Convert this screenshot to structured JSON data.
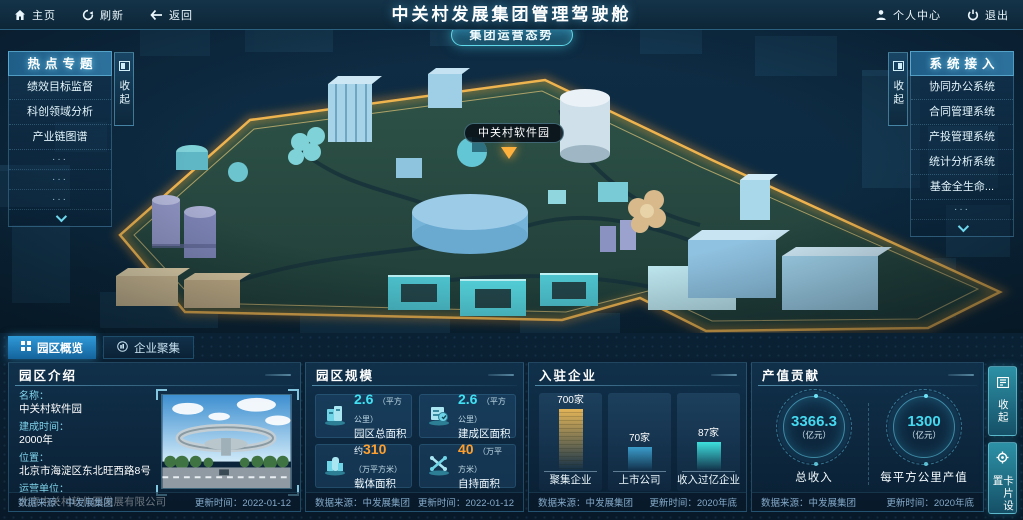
{
  "topbar": {
    "home_label": "主页",
    "refresh_label": "刷新",
    "back_label": "返回",
    "title": "中关村发展集团管理驾驶舱",
    "personal_center_label": "个人中心",
    "logout_label": "退出"
  },
  "map": {
    "situation_button_label": "集团运营态势",
    "park_marker_label": "中关村软件园"
  },
  "hot_topics": {
    "title": "热点专题",
    "collapse_label": "收起",
    "items": [
      "绩效目标监督",
      "科创领域分析",
      "产业链图谱"
    ],
    "placeholders": [
      "···",
      "···",
      "···"
    ]
  },
  "system_access": {
    "title": "系统接入",
    "collapse_label": "收起",
    "items": [
      "协同办公系统",
      "合同管理系统",
      "产投管理系统",
      "统计分析系统",
      "基金全生命..."
    ],
    "placeholders": [
      "···"
    ]
  },
  "tabs": {
    "overview": "园区概览",
    "cluster": "企业聚集"
  },
  "intro_panel": {
    "title": "园区介绍",
    "fields": [
      {
        "label": "名称：",
        "value": "中关村软件园"
      },
      {
        "label": "建成时间：",
        "value": "2000年"
      },
      {
        "label": "位置：",
        "value": "北京市海淀区东北旺西路8号"
      },
      {
        "label": "运营单位：",
        "value": "北京中关村软件园发展有限公司"
      }
    ],
    "source": "数据来源：中发展集团",
    "updated": "更新时间：2022-01-12"
  },
  "scale_panel": {
    "title": "园区规模",
    "cards": [
      {
        "prefix": "",
        "value": "2.6",
        "unit": "（平方公里）",
        "label": "园区总面积",
        "accent": "cyan"
      },
      {
        "prefix": "",
        "value": "2.6",
        "unit": "（平方公里）",
        "label": "建成区面积",
        "accent": "cyan"
      },
      {
        "prefix": "约",
        "value": "310",
        "unit": "（万平方米）",
        "label": "载体面积",
        "accent": "orange"
      },
      {
        "prefix": "",
        "value": "40",
        "unit": "（万平方米）",
        "label": "自持面积",
        "accent": "orange"
      }
    ],
    "source": "数据来源：中发展集团",
    "updated": "更新时间：2022-01-12"
  },
  "enterprise_panel": {
    "title": "入驻企业",
    "chart_data": {
      "type": "bar",
      "categories": [
        "聚集企业",
        "上市公司",
        "收入过亿企业"
      ],
      "values": [
        700,
        70,
        87
      ],
      "value_labels": [
        "700家",
        "70家",
        "87家"
      ],
      "unit": "家",
      "colors": [
        "#e3b457",
        "#3a9ccb",
        "#3ddfdd"
      ],
      "bar_heights_px": [
        62,
        24,
        29
      ],
      "grid": false,
      "legend_position": "none"
    },
    "source": "数据来源：中发展集团",
    "updated": "更新时间：2020年底"
  },
  "output_panel": {
    "title": "产值贡献",
    "stats": [
      {
        "value": "3366.3",
        "unit": "（亿元）",
        "label": "总收入"
      },
      {
        "value": "1300",
        "unit": "（亿元）",
        "label": "每平方公里产值"
      }
    ],
    "source": "数据来源：中发展集团",
    "updated": "更新时间：2020年底"
  },
  "side_buttons": {
    "collapse_label": "收起",
    "card_settings_label": "卡片设置"
  },
  "colors": {
    "accent_cyan": "#41e0f2",
    "accent_orange": "#ffa02e",
    "boundary_glow_gold": "#ffc04d",
    "tab_active_blue": "#2f9ad8",
    "panel_bg": "#10314c"
  }
}
